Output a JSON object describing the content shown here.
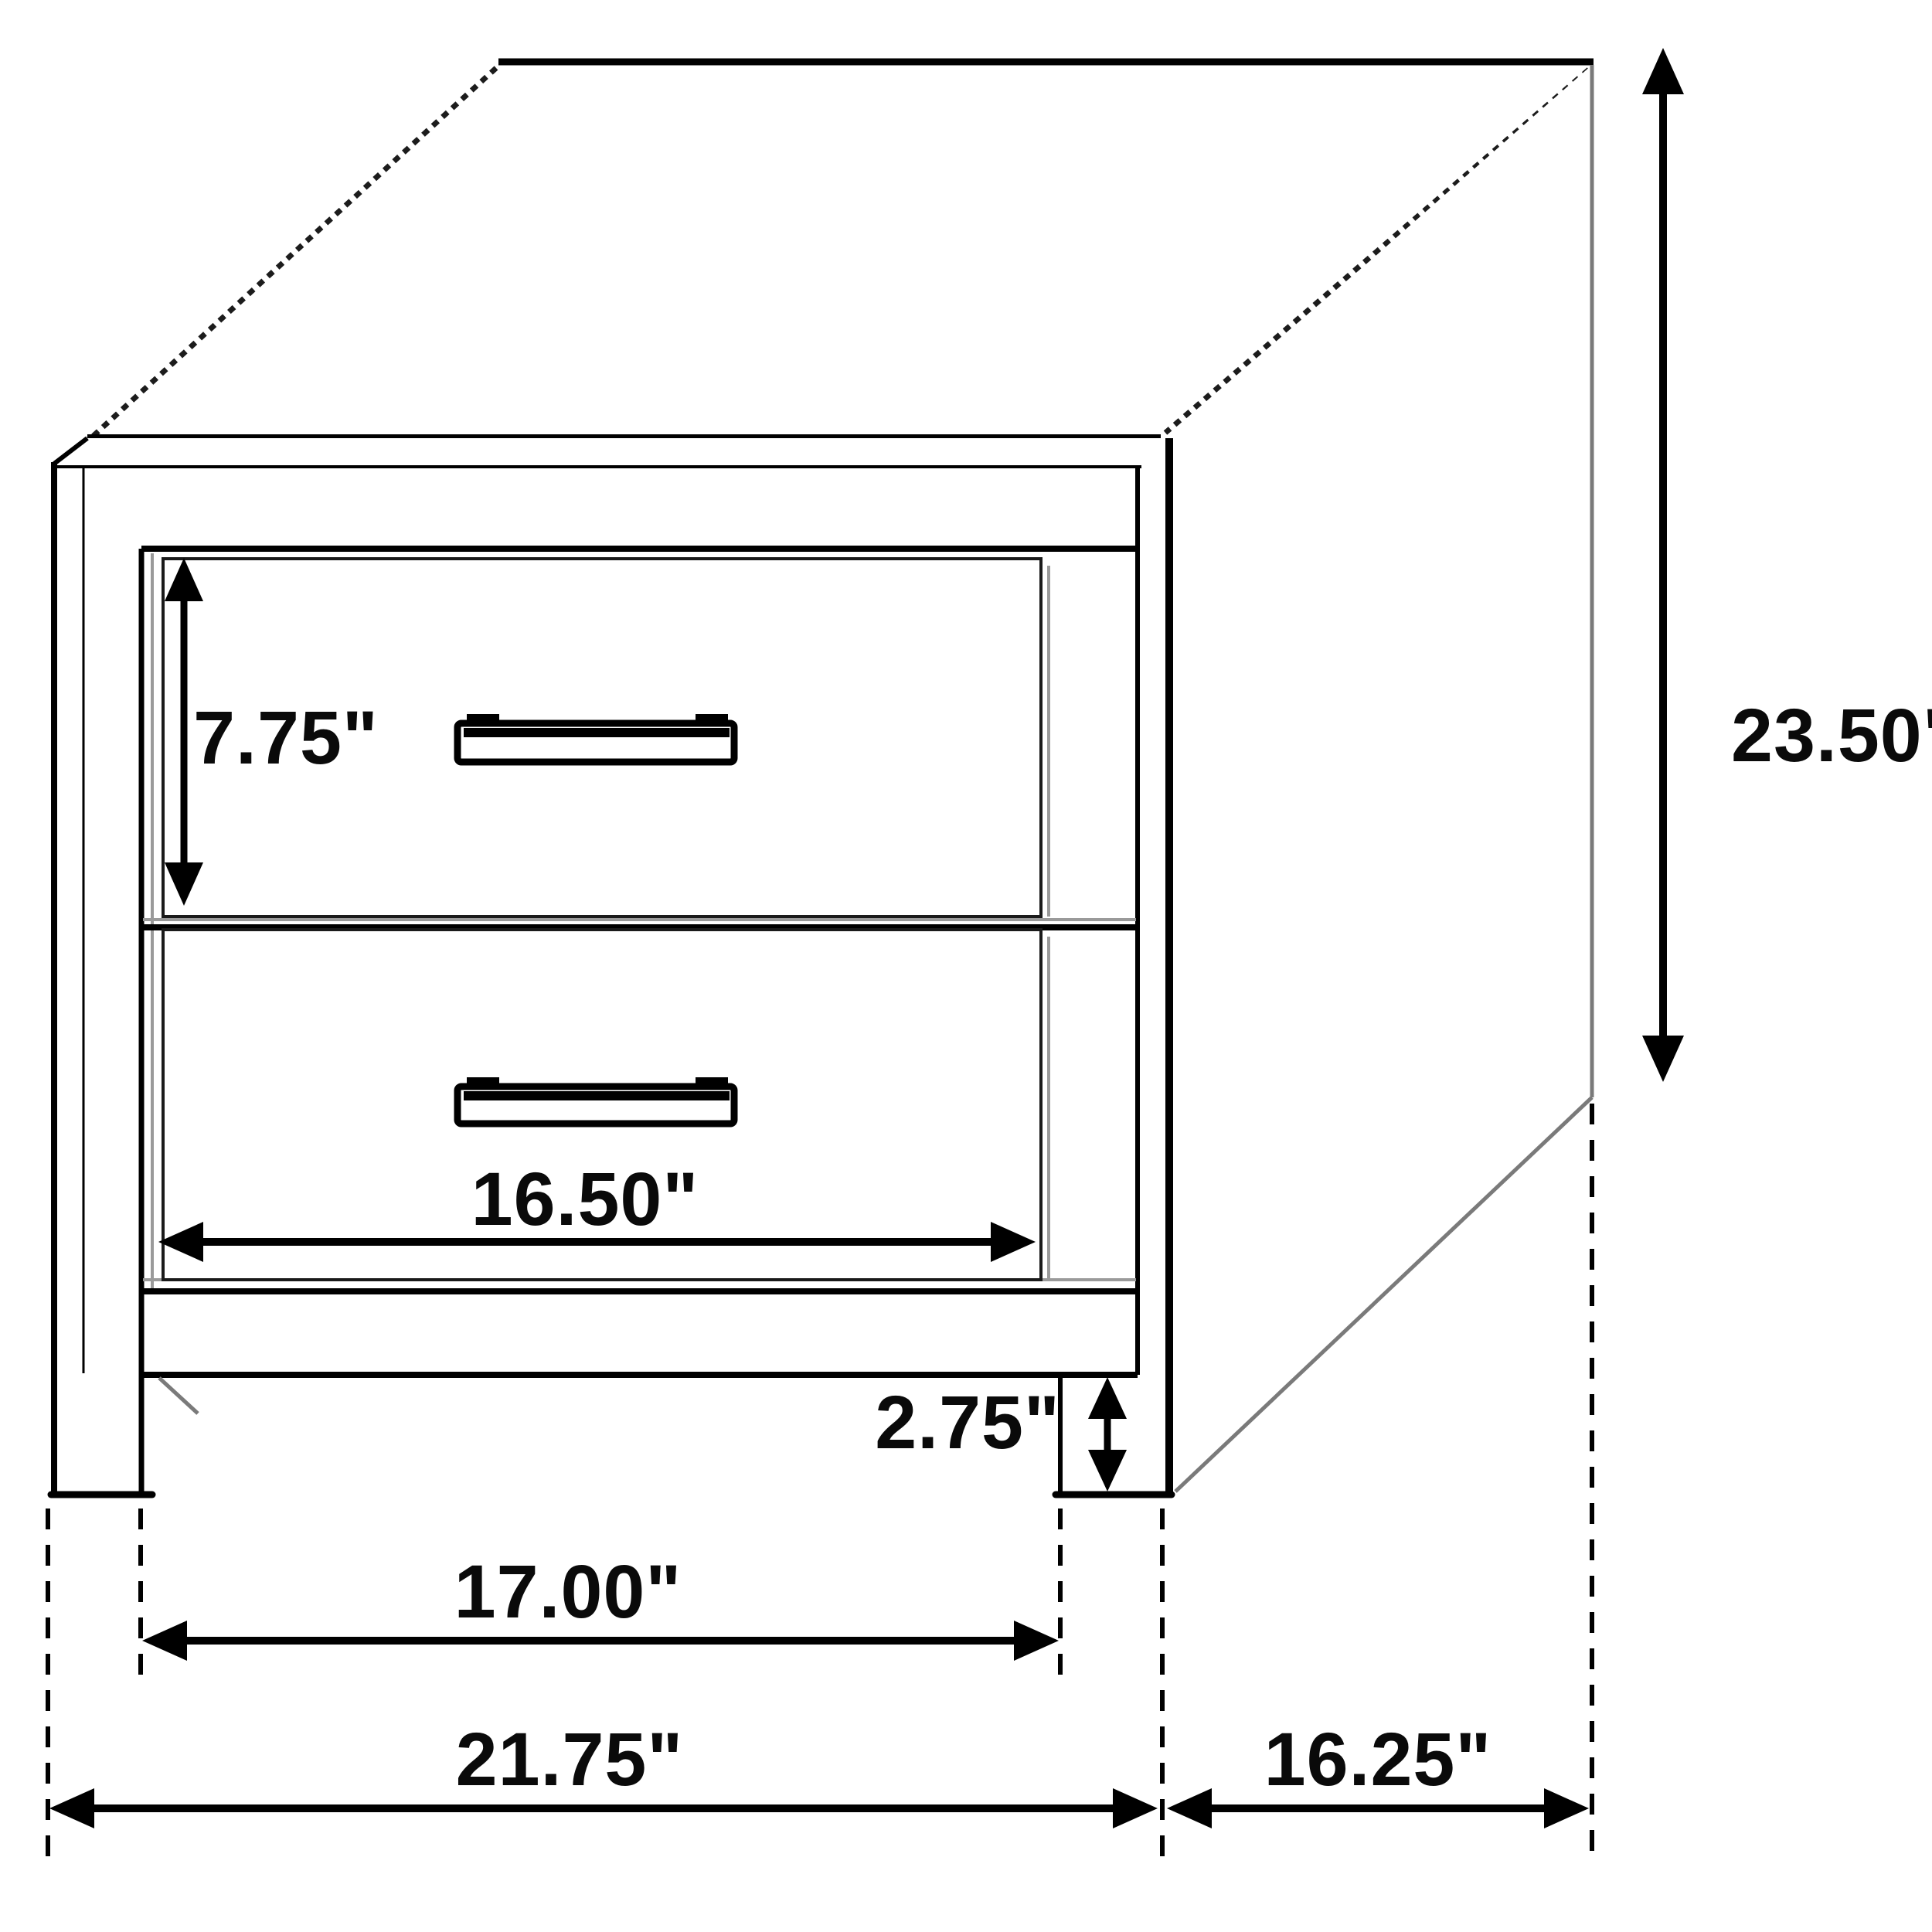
{
  "page": {
    "background": "#ffffff",
    "description": "Line drawing of a two-drawer nightstand with dimension arrows"
  },
  "diagram": {
    "type": "furniture_dimension_diagram",
    "object": "two-drawer nightstand",
    "unit": "inches",
    "line_color": "#000000",
    "shadow_color": "#9a9a9a",
    "text_color": "#0a0a0a",
    "dimensions": {
      "overall_height": {
        "label": "23.50\"",
        "value": 23.5,
        "measures": "total height, right side"
      },
      "top_drawer_height": {
        "label": "7.75\"",
        "value": 7.75,
        "measures": "top drawer front height"
      },
      "drawer_width": {
        "label": "16.50\"",
        "value": 16.5,
        "measures": "drawer front width"
      },
      "leg_height": {
        "label": "2.75\"",
        "value": 2.75,
        "measures": "leg clearance height"
      },
      "inner_leg_span": {
        "label": "17.00\"",
        "value": 17.0,
        "measures": "span between legs"
      },
      "overall_width": {
        "label": "21.75\"",
        "value": 21.75,
        "measures": "overall front width"
      },
      "depth": {
        "label": "16.25\"",
        "value": 16.25,
        "measures": "side depth"
      }
    }
  }
}
